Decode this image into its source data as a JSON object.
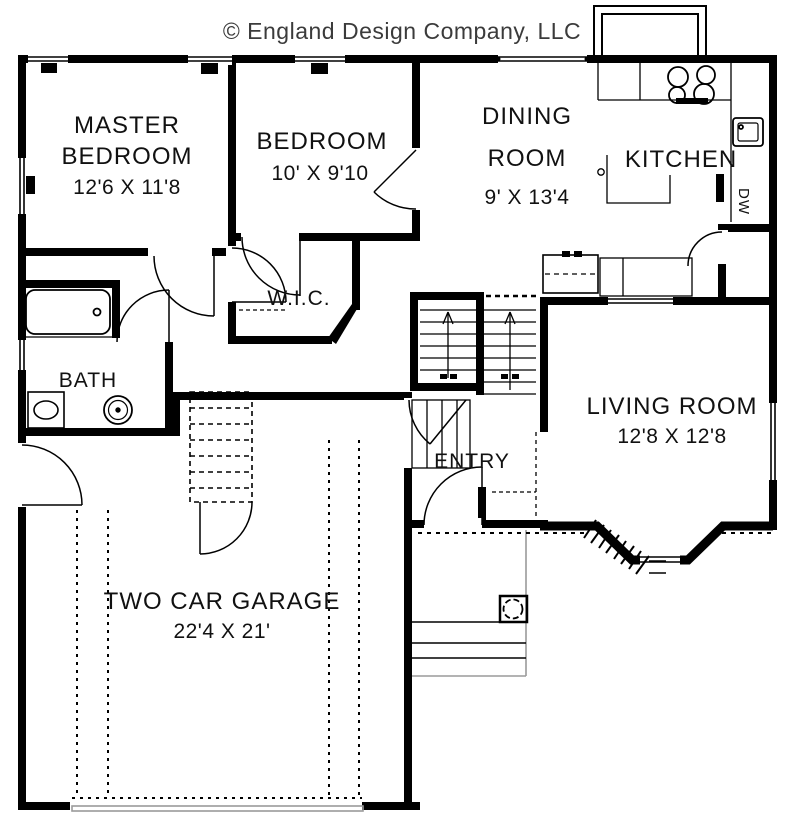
{
  "title": "© England Design Company, LLC",
  "rooms": {
    "master_bedroom": {
      "line1": "MASTER",
      "line2": "BEDROOM",
      "dims": "12'6 X 11'8"
    },
    "bedroom": {
      "name": "BEDROOM",
      "dims": "10' X 9'10"
    },
    "dining_room": {
      "line1": "DINING",
      "line2": "ROOM",
      "dims": "9' X 13'4"
    },
    "kitchen": {
      "name": "KITCHEN"
    },
    "wic": {
      "name": "W.I.C."
    },
    "bath": {
      "name": "BATH"
    },
    "entry": {
      "name": "ENTRY"
    },
    "living_room": {
      "name": "LIVING ROOM",
      "dims": "12'8 X 12'8"
    },
    "garage": {
      "name": "TWO CAR GARAGE",
      "dims": "22'4 X 21'"
    }
  },
  "appliances": {
    "dishwasher": "DW"
  },
  "colors": {
    "ink": "#000000",
    "paper": "#ffffff",
    "copyright": "#3b3b3b",
    "light": "#9a9a9a"
  }
}
